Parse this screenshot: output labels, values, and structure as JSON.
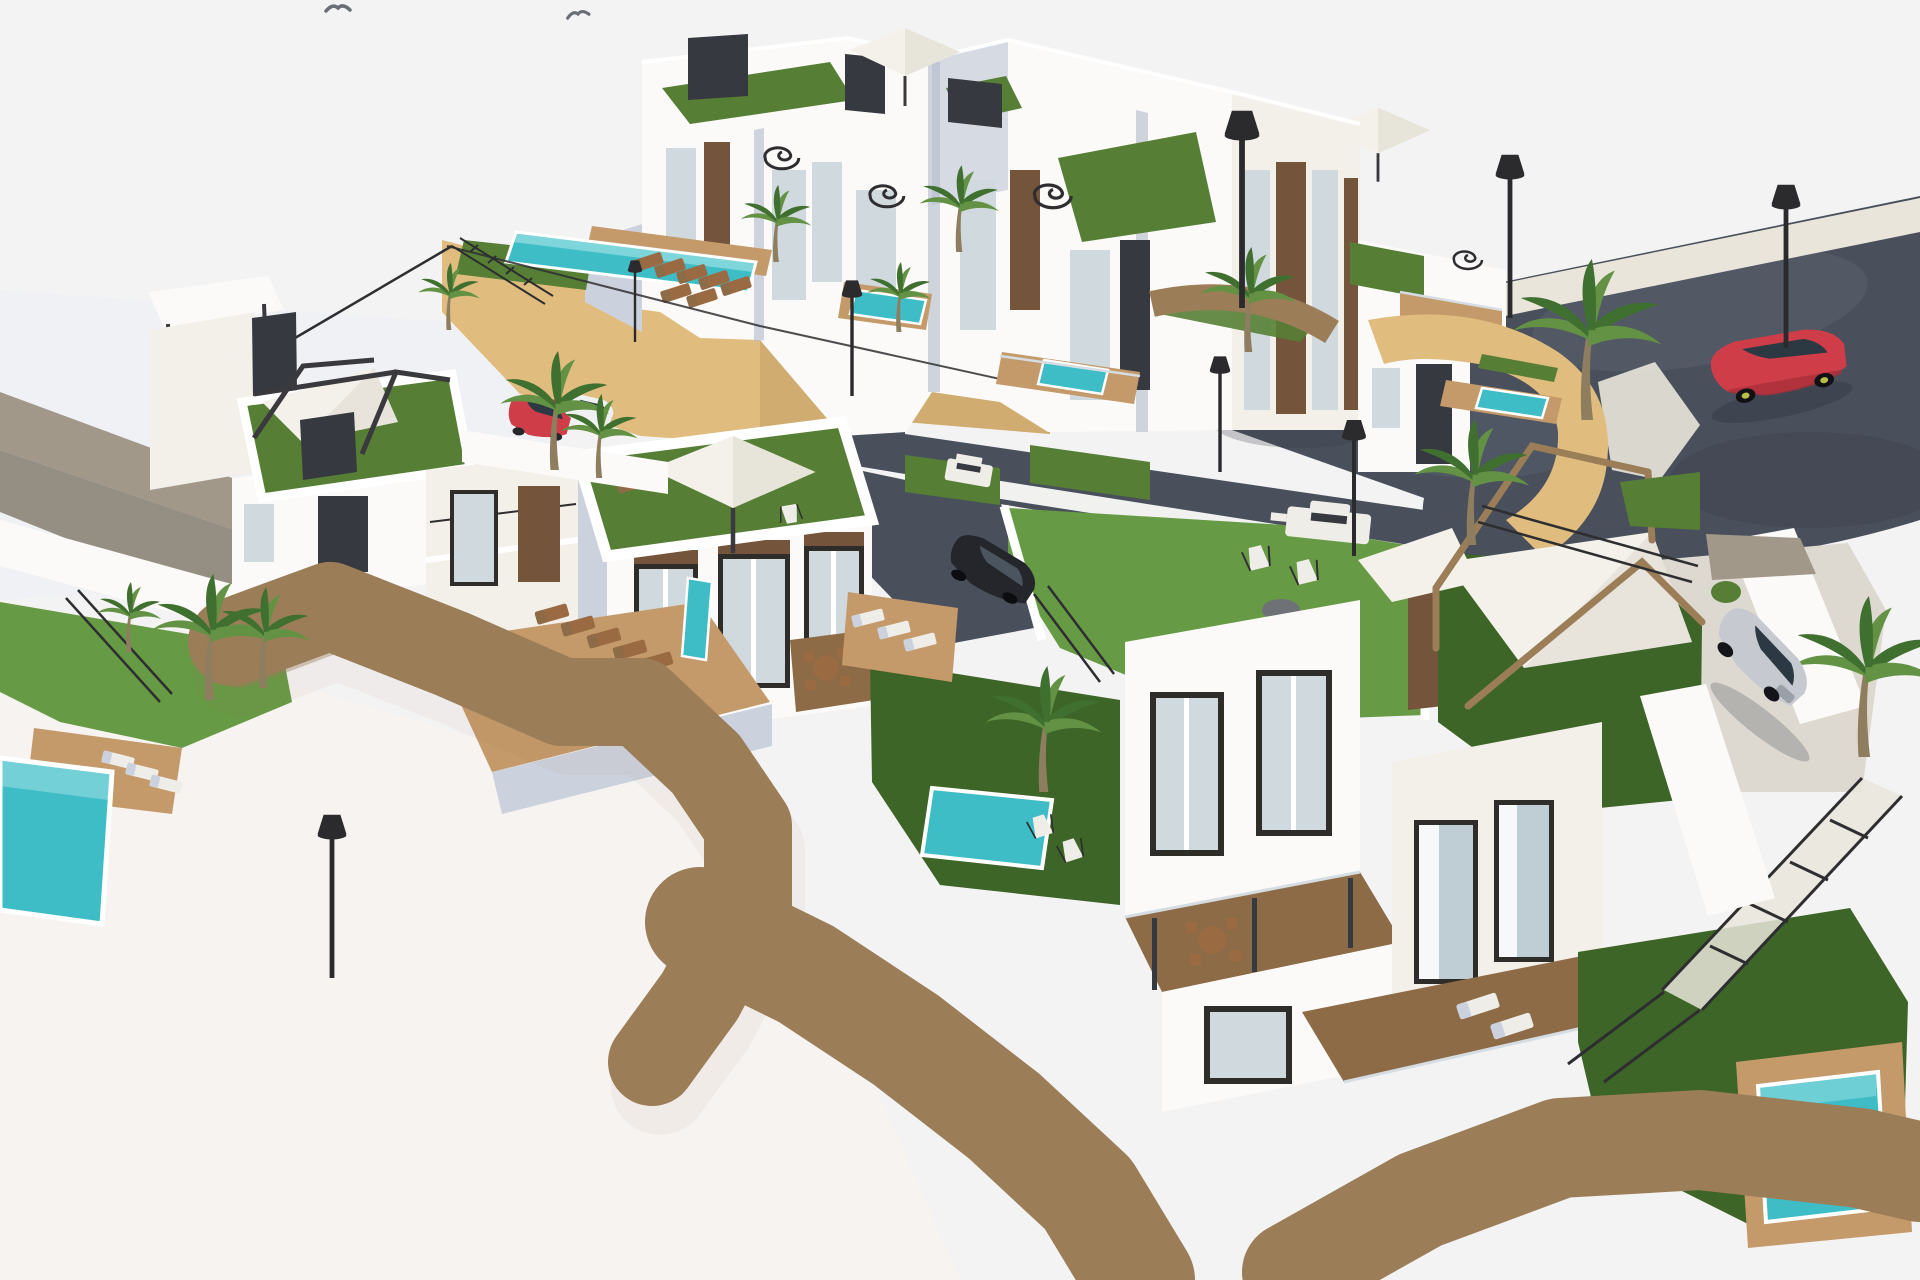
{
  "scene": {
    "type": "architectural-3d-render",
    "view": "aerial-isometric",
    "description": "Aerial 3D visualization of a modern hillside residential development: white multi-storey villas and townhouses with rooftop lawn terraces, turquoise plunge pools, sandstone retaining walls, palm trees, shade pergolas, sun loungers, a curved dark asphalt access road with cul-de-sac, parked cars and street lamps under a pale white sky",
    "elements": {
      "villas": 9,
      "swimming_pools": 8,
      "palm_trees": 14,
      "cars": 4,
      "street_lamps": 8,
      "rooftop_lawn_terraces": 6,
      "umbrellas": 3,
      "shade_pergolas": 3,
      "spiral_staircases": 4,
      "bbq_stations": 2,
      "sun_loungers": 22,
      "deck_chairs": 2,
      "dining_sets": 2,
      "birds": 2
    },
    "vehicles": [
      {
        "name": "red-suv-on-road",
        "color": "#cf3d49"
      },
      {
        "name": "parked-red-suv",
        "color": "#cf3d49"
      },
      {
        "name": "white-sports-car",
        "color": "#eef0f2"
      },
      {
        "name": "black-sedan",
        "color": "#24262b"
      },
      {
        "name": "silver-hatchback",
        "color": "#c6cad0"
      }
    ]
  },
  "palette": {
    "bg": "#f4f3f4",
    "bgWarm": "#f6f3ef",
    "skyBand": "#eceef5",
    "road": "#49505c",
    "roadLight": "#707a88",
    "roadDark": "#373d47",
    "curb": "#e9e5da",
    "paver": "#ddd9d1",
    "stoneYellow": "#e0bd7e",
    "stoneYellowLight": "#ecd49a",
    "stoneYellowDark": "#c09c62",
    "stoneGray": "#a2988a",
    "stoneGrayDark": "#857c6e",
    "whiteSun": "#fbfaf8",
    "whiteWarm": "#f3efe9",
    "whiteShade": "#ccd2dd",
    "whiteShadeDeep": "#b2bac9",
    "lawnBright": "#679a44",
    "lawnMid": "#567f35",
    "lawnDark": "#3d6527",
    "pool": "#3fbdc7",
    "poolLight": "#a8e4e6",
    "deckWood": "#c49a6a",
    "deckWoodDark": "#a37d50",
    "walnut": "#8d6b47",
    "windowFrame": "#2f2d2a",
    "windowGlass": "#cfd9de",
    "glassBlue": "#bfcdd4",
    "panelBrown": "#74543a",
    "panelDark": "#36393f",
    "sail": "#f3f1ea",
    "sailShade": "#ddd8cc",
    "metalDark": "#3a3a3e",
    "pergolaWood": "#9b7d58",
    "carRed": "#cf3d49",
    "carRedDark": "#a92f3a",
    "carWhite": "#eef0f2",
    "carBlack": "#24262b",
    "carSilver": "#c6cad0",
    "carGlass": "#2c3942",
    "palmLit": "#639244",
    "palmDark": "#40702f",
    "palmTrunk": "#8f7d5f",
    "lamp": "#2b2b2e",
    "railing": "#2e2e31",
    "furnWhite": "#efede7",
    "furnBrown": "#9a6b42",
    "pouf": "#6e7276"
  }
}
